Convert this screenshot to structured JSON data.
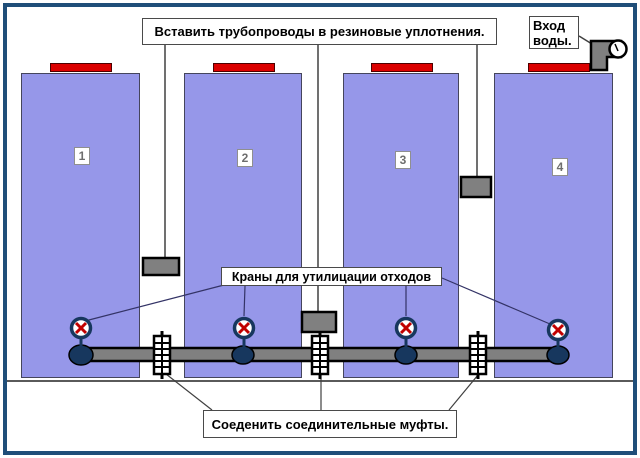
{
  "diagram": {
    "top_note": "Вставить трубопроводы в резиновые уплотнения.",
    "water_inlet_label": "Вход воды.",
    "valves_label": "Краны для утилицации отходов",
    "couplings_label": "Соеденить соединительные муфты.",
    "tanks": [
      {
        "number": "1"
      },
      {
        "number": "2"
      },
      {
        "number": "3"
      },
      {
        "number": "4"
      }
    ],
    "colors": {
      "frame_border": "#1F4E79",
      "tank_fill": "#9697E9",
      "cap_red": "#DB0000",
      "pipe_gray": "#808080",
      "seal_gray": "#808080",
      "valve_navy": "#17375E",
      "valve_x_red": "#C00000",
      "pointer_line": "#404040",
      "valve_pointer_line": "#333366"
    }
  }
}
